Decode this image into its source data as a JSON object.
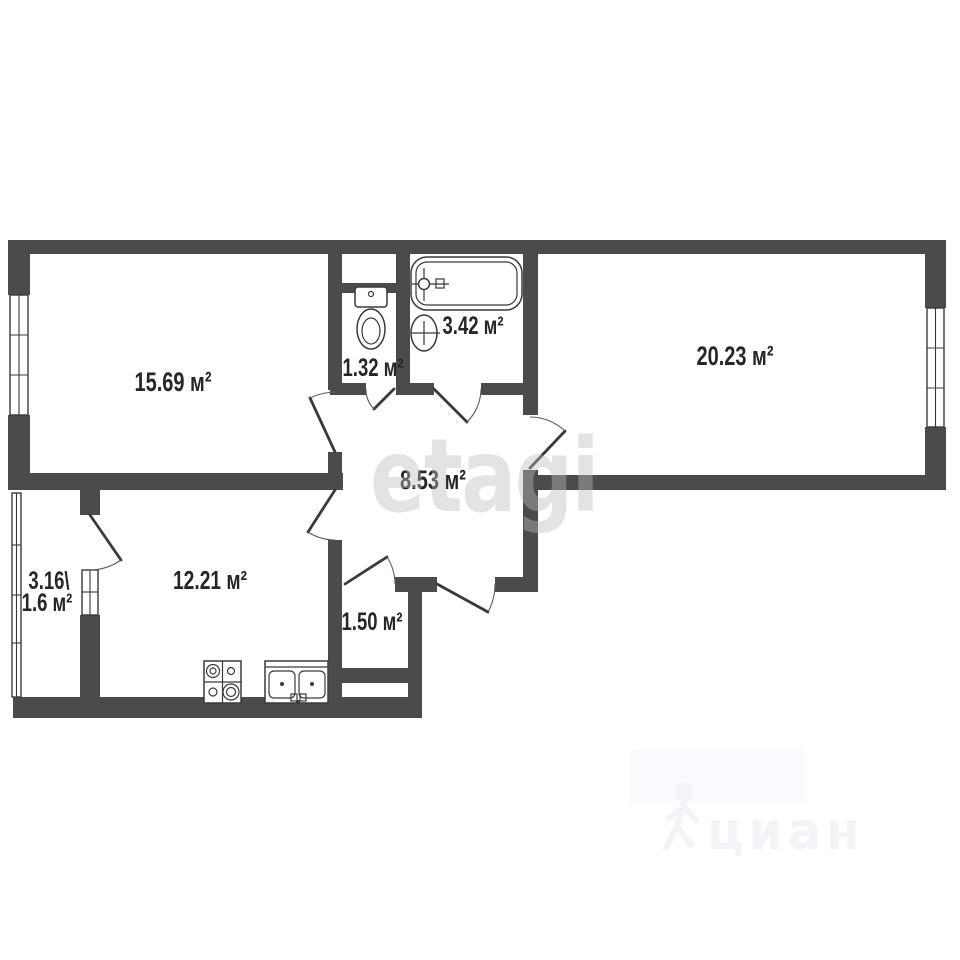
{
  "rooms": {
    "living": {
      "label": "15.69 м²"
    },
    "bedroom": {
      "label": "20.23 м²"
    },
    "wc": {
      "label": "1.32 м²"
    },
    "bathroom": {
      "label": "3.42 м²"
    },
    "hallway": {
      "label": "8.53 м²"
    },
    "kitchen": {
      "label": "12.21 м²"
    },
    "storage": {
      "label": "1.50 м²"
    },
    "balcony": {
      "label_total": "3.16\\",
      "label_reduced": "1.6 м²"
    }
  },
  "fixtures": {
    "bathtub": "bathtub-icon",
    "toilet": "toilet-icon",
    "wash_basin": "wash-basin-icon",
    "stove": "stove-icon",
    "kitchen_sink": "kitchen-sink-icon"
  },
  "watermarks": {
    "center": "etagi",
    "corner": "циан"
  },
  "colors": {
    "wall": "#4a4b4d",
    "line": "#3a3a3a",
    "text": "#262626",
    "watermark_center": "#bcbcbc",
    "watermark_corner": "#f3f4f8",
    "background": "#ffffff"
  }
}
